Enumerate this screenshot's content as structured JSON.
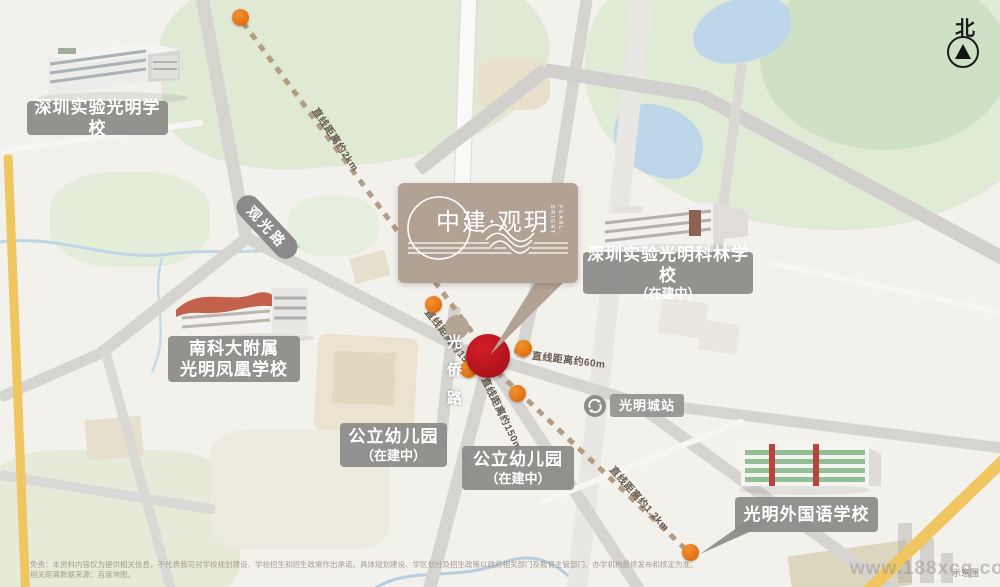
{
  "compass": {
    "north_label": "北"
  },
  "logo": {
    "title": "中建·观玥",
    "subtitle_l1": "BRIGHT",
    "subtitle_l2": "PEARL"
  },
  "labels": {
    "school_shiyan": "深圳实验光明学校",
    "school_kelin_l1": "深圳实验光明科林学校",
    "school_kelin_l2": "（在建中）",
    "school_fenghuang_l1": "南科大附属",
    "school_fenghuang_l2": "光明凤凰学校",
    "kinder1_l1": "公立幼儿园",
    "kinder1_l2": "（在建中）",
    "kinder2_l1": "公立幼儿园",
    "kinder2_l2": "（在建中）",
    "school_waiguoyu": "光明外国语学校",
    "road_guanguang": "观光路",
    "road_guangqiao": "光侨路",
    "station": "光明城站"
  },
  "distances": {
    "to_shiyan": "直线距离约2km",
    "to_east_poi": "直线距离约60m",
    "to_nw_poi": "直线距离约150m",
    "to_south_poi": "直线距离约150m",
    "to_waiguoyu": "直线距离约1.2km"
  },
  "footer": {
    "disclaimer_l1": "免责：本资料内容仅为提供相关信息，不代表我司对学校规划建设、学校招生和招生政策作出承诺。具体规划建设、学区划分及招生政策以政府相关部门及教育主管部门、办学机构最终发布和核定为准。",
    "disclaimer_l2": "相关距离数据来源：百度地图。",
    "diagram_note": "示意图",
    "watermark": "www.188xcq.com"
  },
  "colors": {
    "project_red": "#c1121c",
    "poi_orange": "#e8760f",
    "logo_tan": "#b2a294",
    "dash_brown": "#b59c84",
    "road_yellow": "#f0c660"
  }
}
